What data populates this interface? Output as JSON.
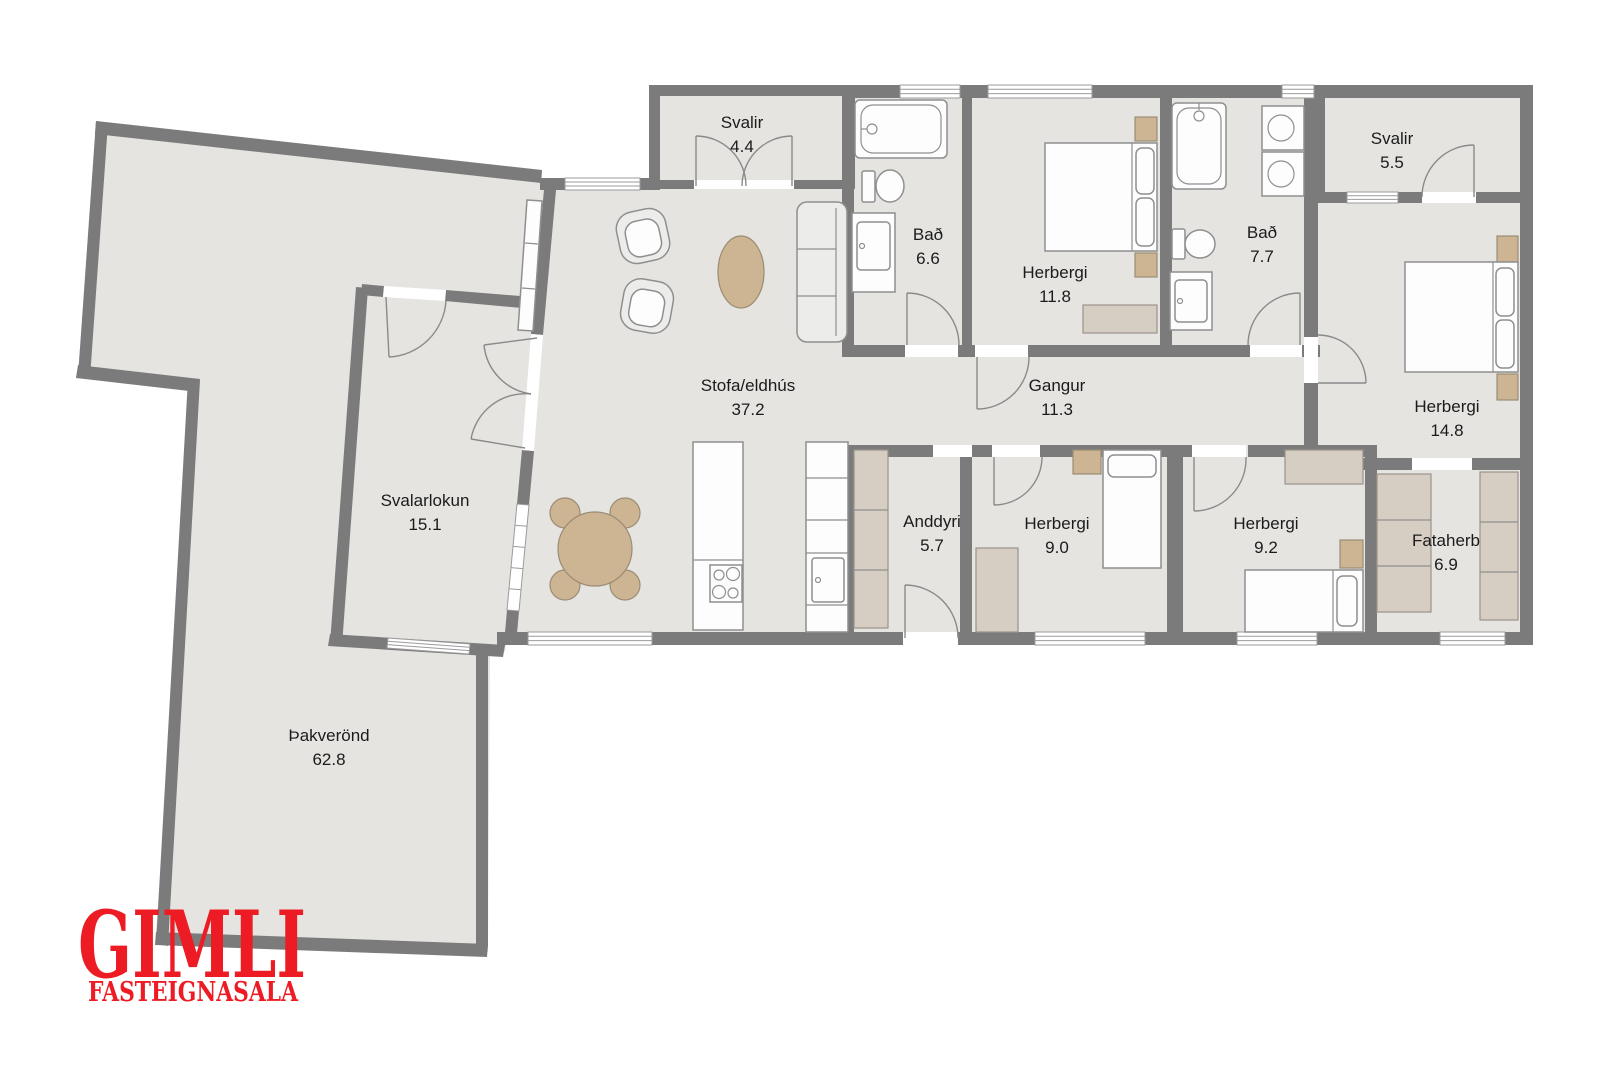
{
  "plan": {
    "rooms": [
      {
        "name": "Svalir",
        "area": "4.4"
      },
      {
        "name": "Bað",
        "area": "6.6"
      },
      {
        "name": "Herbergi",
        "area": "11.8"
      },
      {
        "name": "Bað",
        "area": "7.7"
      },
      {
        "name": "Svalir",
        "area": "5.5"
      },
      {
        "name": "Herbergi",
        "area": "14.8"
      },
      {
        "name": "Stofa/eldhús",
        "area": "37.2"
      },
      {
        "name": "Gangur",
        "area": "11.3"
      },
      {
        "name": "Anddyri",
        "area": "5.7"
      },
      {
        "name": "Herbergi",
        "area": "9.0"
      },
      {
        "name": "Herbergi",
        "area": "9.2"
      },
      {
        "name": "Fataherb",
        "area": "6.9"
      },
      {
        "name": "Svalarlokun",
        "area": "15.1"
      },
      {
        "name": "Þakverönd",
        "area": "62.8"
      }
    ],
    "logo": {
      "title": "GIMLI",
      "subtitle": "FASTEIGNASALA"
    },
    "colors": {
      "logo_red": "#ed1c24",
      "wall_gray": "#7b7b7b",
      "floor_gray": "#e5e4e1",
      "accent_tan": "#cdb492",
      "accent_beige": "#d6cdc3"
    }
  }
}
